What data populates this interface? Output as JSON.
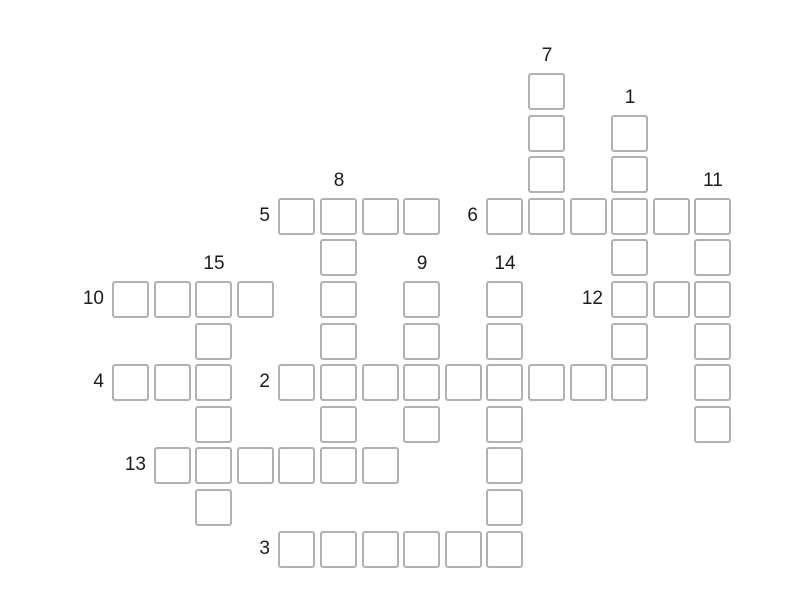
{
  "page": {
    "background": "#ffffff"
  },
  "grid": {
    "origin_x": 112,
    "origin_y": 73,
    "pitch": 41.6,
    "cell_size": 37,
    "cell_fill": "#ffffff",
    "border_color": "#b1b1b1",
    "border_width": 2,
    "corner_radius": 3,
    "number_color": "#1c1c1c",
    "number_font_size": 19
  },
  "words": [
    {
      "number": "1",
      "direction": "down",
      "col": 12,
      "row": 1,
      "length": 7
    },
    {
      "number": "2",
      "direction": "across",
      "col": 4,
      "row": 7,
      "length": 9
    },
    {
      "number": "3",
      "direction": "across",
      "col": 4,
      "row": 11,
      "length": 6
    },
    {
      "number": "4",
      "direction": "across",
      "col": 0,
      "row": 7,
      "length": 3
    },
    {
      "number": "5",
      "direction": "across",
      "col": 4,
      "row": 3,
      "length": 4
    },
    {
      "number": "6",
      "direction": "across",
      "col": 9,
      "row": 3,
      "length": 6
    },
    {
      "number": "7",
      "direction": "down",
      "col": 10,
      "row": 0,
      "length": 4
    },
    {
      "number": "8",
      "direction": "down",
      "col": 5,
      "row": 3,
      "length": 7
    },
    {
      "number": "9",
      "direction": "down",
      "col": 7,
      "row": 5,
      "length": 4
    },
    {
      "number": "10",
      "direction": "across",
      "col": 0,
      "row": 5,
      "length": 4
    },
    {
      "number": "11",
      "direction": "down",
      "col": 14,
      "row": 3,
      "length": 6
    },
    {
      "number": "12",
      "direction": "across",
      "col": 12,
      "row": 5,
      "length": 3
    },
    {
      "number": "13",
      "direction": "across",
      "col": 1,
      "row": 9,
      "length": 6
    },
    {
      "number": "14",
      "direction": "down",
      "col": 9,
      "row": 5,
      "length": 7
    },
    {
      "number": "15",
      "direction": "down",
      "col": 2,
      "row": 5,
      "length": 6
    }
  ]
}
